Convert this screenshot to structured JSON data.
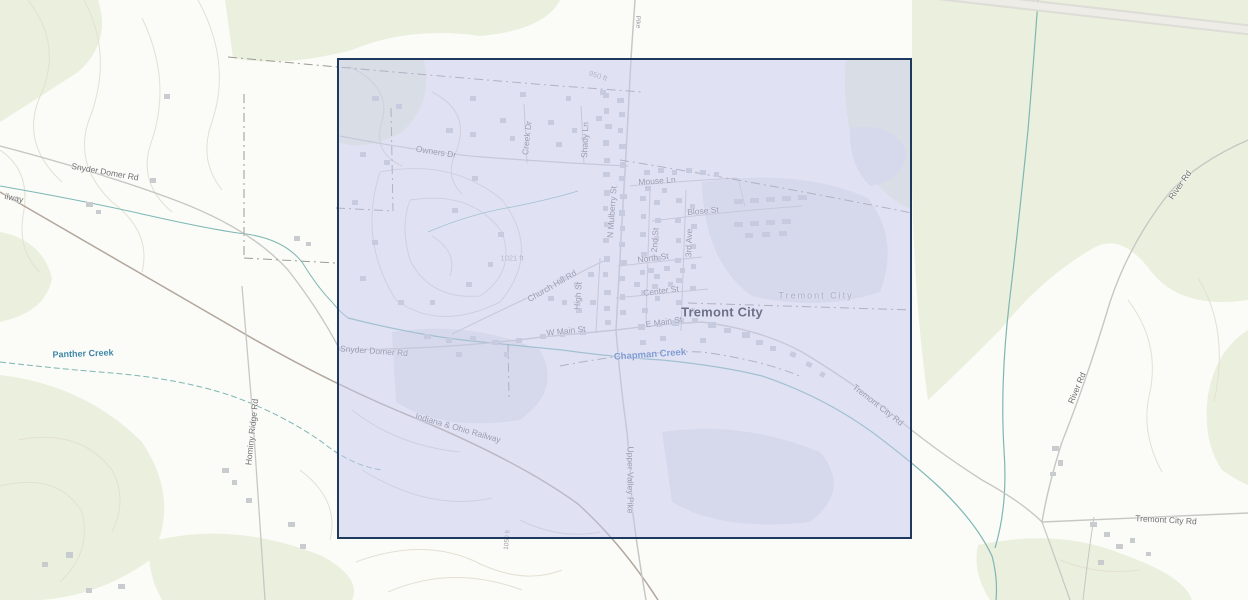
{
  "map": {
    "town_name": "Tremont City",
    "selection": {
      "x": 337,
      "y": 58,
      "width": 575,
      "height": 481
    },
    "colors": {
      "veg": "#eaf0dd",
      "urban": "#e7e9e6",
      "contour": "#e4e0d2",
      "contourIn": "#d9d7cf",
      "water": "#7db7b3",
      "railway": "#b2a79d",
      "road": "#c7c7c3",
      "band": "#dedcd6",
      "band2": "#edece7",
      "boundary": "#9b9b95",
      "building": "#c9cccf",
      "labelRoad": "#6e6e6c",
      "labelWater": "#3a6fb0",
      "selectionFill": "rgba(197,201,240,0.50)",
      "selectionBorder": "#1d3a5e"
    },
    "labels": [
      {
        "text": "Owners Dr",
        "x": 436,
        "y": 152,
        "rot": 9,
        "cls": ""
      },
      {
        "text": "Creek Dr",
        "x": 527,
        "y": 138,
        "rot": -84,
        "cls": ""
      },
      {
        "text": "Shady Ln",
        "x": 585,
        "y": 140,
        "rot": -88,
        "cls": ""
      },
      {
        "text": "950 ft",
        "x": 598,
        "y": 76,
        "rot": 18,
        "cls": "lbl-elev"
      },
      {
        "text": "N Mulberry St",
        "x": 612,
        "y": 212,
        "rot": -86,
        "cls": ""
      },
      {
        "text": "Mouse Ln",
        "x": 657,
        "y": 181,
        "rot": -4,
        "cls": ""
      },
      {
        "text": "Blose St",
        "x": 703,
        "y": 211,
        "rot": -5,
        "cls": ""
      },
      {
        "text": "2nd St",
        "x": 655,
        "y": 240,
        "rot": -86,
        "cls": ""
      },
      {
        "text": "3rd Ave",
        "x": 689,
        "y": 243,
        "rot": -88,
        "cls": ""
      },
      {
        "text": "North St",
        "x": 653,
        "y": 258,
        "rot": -7,
        "cls": ""
      },
      {
        "text": "1021 ft",
        "x": 512,
        "y": 258,
        "rot": 0,
        "cls": "lbl-elev"
      },
      {
        "text": "Church Hill Rd",
        "x": 552,
        "y": 286,
        "rot": -30,
        "cls": ""
      },
      {
        "text": "High St",
        "x": 578,
        "y": 296,
        "rot": -86,
        "cls": ""
      },
      {
        "text": "Center St",
        "x": 661,
        "y": 291,
        "rot": -7,
        "cls": ""
      },
      {
        "text": "Tremont City",
        "x": 816,
        "y": 296,
        "rot": 0,
        "cls": "lbl-boundary"
      },
      {
        "text": "Tremont City",
        "x": 722,
        "y": 312,
        "rot": 0,
        "cls": "lbl-town"
      },
      {
        "text": "E Main St",
        "x": 664,
        "y": 322,
        "rot": -8,
        "cls": ""
      },
      {
        "text": "W Main St",
        "x": 566,
        "y": 331,
        "rot": -6,
        "cls": ""
      },
      {
        "text": "Snyder Domer Rd",
        "x": 105,
        "y": 172,
        "rot": 10,
        "cls": ""
      },
      {
        "text": "Snyder Domer Rd",
        "x": 374,
        "y": 351,
        "rot": 4,
        "cls": ""
      },
      {
        "text": "Chapman Creek",
        "x": 650,
        "y": 355,
        "rot": -4,
        "cls": "lbl-water"
      },
      {
        "text": "Indiana & Ohio Railway",
        "x": 458,
        "y": 428,
        "rot": 16,
        "cls": ""
      },
      {
        "text": "Tremont City Rd",
        "x": 878,
        "y": 405,
        "rot": 38,
        "cls": ""
      },
      {
        "text": "Tremont City Rd",
        "x": 1166,
        "y": 520,
        "rot": 3,
        "cls": ""
      },
      {
        "text": "River Rd",
        "x": 1077,
        "y": 388,
        "rot": -67,
        "cls": ""
      },
      {
        "text": "River Rd",
        "x": 1180,
        "y": 185,
        "rot": -55,
        "cls": ""
      },
      {
        "text": "Panther Creek",
        "x": 83,
        "y": 354,
        "rot": -2,
        "cls": "lbl-water2"
      },
      {
        "text": "Hominy Ridge Rd",
        "x": 252,
        "y": 432,
        "rot": -84,
        "cls": ""
      },
      {
        "text": "Upper Valley Pike",
        "x": 630,
        "y": 480,
        "rot": 90,
        "cls": ""
      },
      {
        "text": "ilway",
        "x": 14,
        "y": 198,
        "rot": 12,
        "cls": ""
      },
      {
        "text": "Pike",
        "x": 637,
        "y": 22,
        "rot": 88,
        "cls": "lbl-tiny"
      },
      {
        "text": "1050 ft",
        "x": 508,
        "y": 540,
        "rot": -85,
        "cls": "lbl-tiny"
      }
    ],
    "buildings": [
      [
        603,
        93,
        6,
        5
      ],
      [
        617,
        98,
        7,
        5
      ],
      [
        604,
        108,
        5,
        6
      ],
      [
        619,
        112,
        6,
        5
      ],
      [
        605,
        124,
        7,
        5
      ],
      [
        618,
        128,
        5,
        5
      ],
      [
        603,
        140,
        6,
        6
      ],
      [
        619,
        144,
        7,
        5
      ],
      [
        604,
        158,
        6,
        5
      ],
      [
        620,
        162,
        5,
        6
      ],
      [
        603,
        172,
        7,
        5
      ],
      [
        619,
        176,
        6,
        5
      ],
      [
        604,
        190,
        6,
        6
      ],
      [
        620,
        194,
        7,
        5
      ],
      [
        603,
        206,
        5,
        5
      ],
      [
        619,
        210,
        6,
        6
      ],
      [
        604,
        222,
        7,
        5
      ],
      [
        620,
        226,
        5,
        5
      ],
      [
        603,
        238,
        6,
        5
      ],
      [
        619,
        242,
        6,
        5
      ],
      [
        604,
        256,
        6,
        6
      ],
      [
        620,
        260,
        7,
        5
      ],
      [
        603,
        272,
        5,
        5
      ],
      [
        619,
        276,
        6,
        5
      ],
      [
        604,
        290,
        7,
        5
      ],
      [
        620,
        294,
        5,
        6
      ],
      [
        604,
        306,
        6,
        5
      ],
      [
        620,
        310,
        6,
        5
      ],
      [
        605,
        320,
        6,
        5
      ],
      [
        640,
        196,
        6,
        5
      ],
      [
        654,
        200,
        6,
        5
      ],
      [
        641,
        214,
        5,
        5
      ],
      [
        655,
        218,
        6,
        5
      ],
      [
        640,
        232,
        6,
        5
      ],
      [
        654,
        236,
        5,
        5
      ],
      [
        641,
        252,
        6,
        5
      ],
      [
        655,
        256,
        6,
        5
      ],
      [
        640,
        270,
        5,
        5
      ],
      [
        654,
        274,
        6,
        5
      ],
      [
        641,
        290,
        6,
        5
      ],
      [
        655,
        296,
        5,
        5
      ],
      [
        642,
        308,
        6,
        5
      ],
      [
        676,
        198,
        6,
        5
      ],
      [
        690,
        204,
        5,
        5
      ],
      [
        675,
        218,
        6,
        5
      ],
      [
        691,
        224,
        6,
        5
      ],
      [
        676,
        238,
        5,
        5
      ],
      [
        690,
        244,
        6,
        5
      ],
      [
        675,
        258,
        6,
        5
      ],
      [
        691,
        264,
        5,
        5
      ],
      [
        676,
        278,
        6,
        5
      ],
      [
        690,
        286,
        6,
        5
      ],
      [
        676,
        300,
        6,
        5
      ],
      [
        690,
        308,
        5,
        5
      ],
      [
        677,
        318,
        7,
        5
      ],
      [
        644,
        170,
        6,
        5
      ],
      [
        658,
        168,
        6,
        5
      ],
      [
        672,
        170,
        5,
        5
      ],
      [
        686,
        168,
        6,
        5
      ],
      [
        700,
        170,
        6,
        5
      ],
      [
        714,
        172,
        5,
        5
      ],
      [
        645,
        186,
        6,
        5
      ],
      [
        662,
        188,
        5,
        5
      ],
      [
        734,
        199,
        9,
        5
      ],
      [
        750,
        198,
        9,
        5
      ],
      [
        766,
        197,
        9,
        5
      ],
      [
        782,
        196,
        9,
        5
      ],
      [
        798,
        195,
        9,
        5
      ],
      [
        734,
        222,
        9,
        5
      ],
      [
        750,
        221,
        9,
        5
      ],
      [
        766,
        220,
        9,
        5
      ],
      [
        782,
        219,
        9,
        5
      ],
      [
        745,
        233,
        8,
        5
      ],
      [
        762,
        232,
        8,
        5
      ],
      [
        779,
        231,
        8,
        5
      ],
      [
        648,
        268,
        6,
        5
      ],
      [
        664,
        266,
        6,
        5
      ],
      [
        680,
        268,
        5,
        5
      ],
      [
        634,
        282,
        6,
        5
      ],
      [
        652,
        284,
        6,
        5
      ],
      [
        668,
        282,
        5,
        5
      ],
      [
        638,
        324,
        7,
        6
      ],
      [
        656,
        322,
        6,
        5
      ],
      [
        672,
        320,
        7,
        6
      ],
      [
        692,
        318,
        6,
        5
      ],
      [
        708,
        322,
        8,
        6
      ],
      [
        724,
        328,
        7,
        5
      ],
      [
        742,
        332,
        8,
        6
      ],
      [
        700,
        338,
        6,
        5
      ],
      [
        660,
        336,
        6,
        5
      ],
      [
        640,
        340,
        6,
        5
      ],
      [
        756,
        340,
        7,
        5
      ],
      [
        770,
        346,
        6,
        5
      ],
      [
        790,
        352,
        6,
        5,
        20
      ],
      [
        806,
        362,
        6,
        5,
        25
      ],
      [
        820,
        372,
        5,
        5,
        30
      ],
      [
        424,
        334,
        7,
        5
      ],
      [
        446,
        338,
        6,
        5
      ],
      [
        470,
        336,
        6,
        5
      ],
      [
        492,
        340,
        7,
        5
      ],
      [
        516,
        338,
        6,
        5
      ],
      [
        540,
        334,
        6,
        5
      ],
      [
        560,
        332,
        5,
        5
      ],
      [
        580,
        330,
        6,
        5
      ],
      [
        456,
        352,
        6,
        5
      ],
      [
        504,
        352,
        5,
        5
      ],
      [
        560,
        276,
        6,
        5
      ],
      [
        574,
        282,
        5,
        5
      ],
      [
        588,
        272,
        6,
        5
      ],
      [
        590,
        300,
        6,
        5
      ],
      [
        576,
        308,
        6,
        5
      ],
      [
        562,
        300,
        5,
        5
      ],
      [
        548,
        296,
        6,
        5
      ],
      [
        446,
        128,
        7,
        5
      ],
      [
        470,
        132,
        6,
        5
      ],
      [
        500,
        118,
        6,
        5
      ],
      [
        510,
        136,
        5,
        5
      ],
      [
        548,
        120,
        6,
        5
      ],
      [
        556,
        142,
        6,
        5
      ],
      [
        596,
        116,
        6,
        5
      ],
      [
        572,
        128,
        5,
        5
      ],
      [
        470,
        96,
        6,
        5
      ],
      [
        520,
        92,
        6,
        5
      ],
      [
        566,
        96,
        5,
        5
      ],
      [
        600,
        90,
        6,
        5
      ],
      [
        372,
        96,
        7,
        5
      ],
      [
        396,
        104,
        6,
        5
      ],
      [
        360,
        152,
        6,
        5
      ],
      [
        384,
        160,
        6,
        5
      ],
      [
        352,
        200,
        6,
        5
      ],
      [
        372,
        240,
        6,
        5
      ],
      [
        360,
        276,
        6,
        5
      ],
      [
        398,
        300,
        6,
        5
      ],
      [
        430,
        300,
        5,
        5
      ],
      [
        466,
        282,
        6,
        5
      ],
      [
        488,
        262,
        5,
        5
      ],
      [
        472,
        176,
        6,
        5
      ],
      [
        452,
        208,
        6,
        5
      ],
      [
        498,
        232,
        6,
        5
      ],
      [
        86,
        202,
        7,
        5
      ],
      [
        96,
        210,
        5,
        4
      ],
      [
        150,
        178,
        6,
        5
      ],
      [
        294,
        236,
        6,
        5
      ],
      [
        306,
        242,
        5,
        4
      ],
      [
        164,
        94,
        6,
        5
      ],
      [
        222,
        468,
        7,
        5
      ],
      [
        232,
        480,
        5,
        5
      ],
      [
        246,
        498,
        6,
        5
      ],
      [
        288,
        522,
        7,
        5
      ],
      [
        300,
        544,
        6,
        5
      ],
      [
        66,
        552,
        7,
        6
      ],
      [
        42,
        562,
        6,
        5
      ],
      [
        118,
        584,
        7,
        5
      ],
      [
        86,
        588,
        6,
        5
      ],
      [
        1052,
        446,
        7,
        5
      ],
      [
        1058,
        460,
        5,
        6
      ],
      [
        1050,
        472,
        6,
        4
      ],
      [
        1090,
        522,
        7,
        5
      ],
      [
        1104,
        532,
        6,
        5
      ],
      [
        1116,
        544,
        7,
        5
      ],
      [
        1130,
        538,
        5,
        5
      ],
      [
        1098,
        560,
        6,
        5
      ],
      [
        1146,
        552,
        5,
        4
      ]
    ]
  }
}
